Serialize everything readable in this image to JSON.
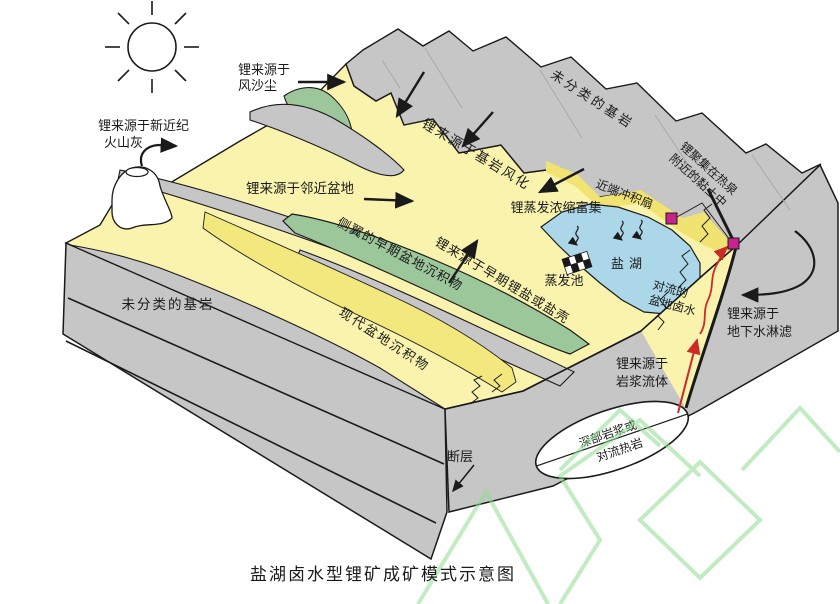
{
  "figure": {
    "caption": "盐湖卤水型锂矿成矿模式示意图"
  },
  "labels": {
    "wind_dust_line1": "锂来源于",
    "wind_dust_line2": "风沙尘",
    "volcanic_ash_line1": "锂来源于新近纪",
    "volcanic_ash_line2": "火山灰",
    "bedrock_mountain": "未分类的基岩",
    "bedrock_weathering": "锂来源于基岩风化",
    "adjacent_basin": "锂来源于邻近盆地",
    "proximal_fan": "近端冲积扇",
    "hot_spring_clay_line1": "锂聚集在热泉",
    "hot_spring_clay_line2": "附近的黏土中",
    "evaporation_enrichment": "锂蒸发浓缩富集",
    "salt_lake": "盐湖",
    "evaporation_pond": "蒸发池",
    "convecting_brine_line1": "对流的",
    "convecting_brine_line2": "盆地卤水",
    "flank_early_sediments": "侧翼的早期盆地沉积物",
    "early_li_salts": "锂来源于早期锂盐或盐壳",
    "modern_sediments": "现代盆地沉积物",
    "bedrock_front": "未分类的基岩",
    "groundwater_line1": "锂来源于",
    "groundwater_line2": "地下水淋滤",
    "magmatic_line1": "锂来源于",
    "magmatic_line2": "岩浆流体",
    "fault": "断层",
    "deep_magma_line1": "深部岩浆或",
    "deep_magma_line2": "对流热岩"
  },
  "colors": {
    "bedrock_gray": "#c6c6c6",
    "basin_yellow": "#f9f3ae",
    "channel_yellow": "#f2e87e",
    "fan_yellow": "#f1e372",
    "sediment_green": "#9cc79b",
    "lake_blue": "#abd7e9",
    "hot_spring_magenta": "#c7228f",
    "magma_red": "#cc2a28",
    "watermark_green": "#8fdc8f",
    "outline": "#1a1a1a"
  }
}
